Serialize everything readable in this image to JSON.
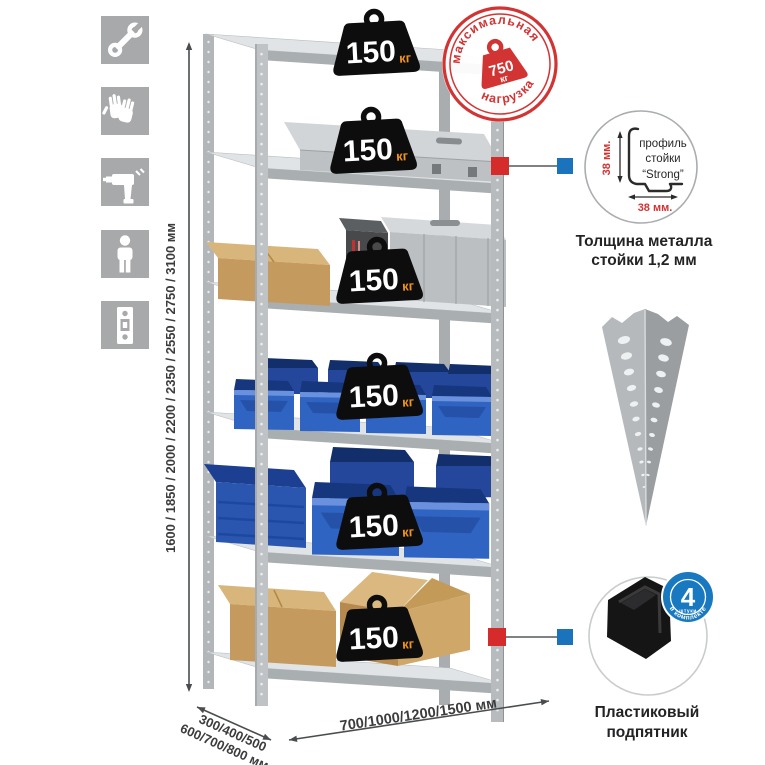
{
  "icons": {
    "sidebar": [
      "wrench-icon",
      "work-gloves-icon",
      "drill-icon",
      "person-icon",
      "rack-post-icon"
    ],
    "square_color": "#a7a9ab",
    "glyph_color": "#ffffff"
  },
  "shelves": [
    {
      "load": "150",
      "unit": "кг"
    },
    {
      "load": "150",
      "unit": "кг"
    },
    {
      "load": "150",
      "unit": "кг"
    },
    {
      "load": "150",
      "unit": "кг"
    },
    {
      "load": "150",
      "unit": "кг"
    },
    {
      "load": "150",
      "unit": "кг"
    }
  ],
  "stamp": {
    "arc_top": "максимальная",
    "arc_bottom": "нагрузка",
    "value": "750",
    "unit": "кг",
    "color": "#d23434"
  },
  "dims": {
    "height": "1600 / 1850 / 2000 / 2200 / 2350 / 2550 / 2750 / 3100 мм",
    "depth1": "300/400/500",
    "depth2": "600/700/800 мм",
    "width": "700/1000/1200/1500 мм"
  },
  "profile": {
    "word1": "профиль",
    "word2": "стойки",
    "word3": "“Strong”",
    "dim_v": "38 мм.",
    "dim_h": "38 мм.",
    "cap1": "Толщина металла",
    "cap2": "стойки 1,2 мм"
  },
  "foot": {
    "count": "4",
    "count_sub": "штуки",
    "arc": "в комплекте",
    "cap1": "Пластиковый",
    "cap2": "подпятник",
    "badge_color": "#1878c0"
  },
  "callout_colors": {
    "source_marker": "#d52b2b",
    "target_marker": "#1a73bb"
  }
}
